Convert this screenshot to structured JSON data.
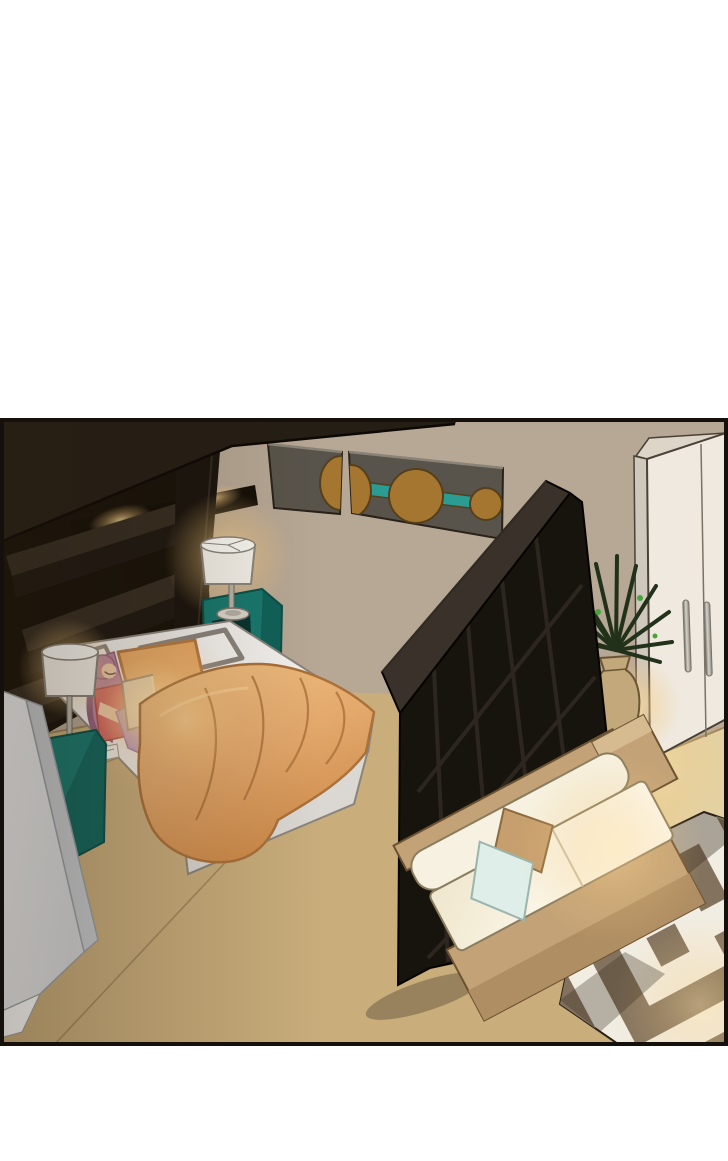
{
  "panel": {
    "x": 2,
    "y": 420,
    "width": 724,
    "height": 624
  },
  "scene": {
    "description": "Webtoon comic panel: isometric night bedroom. A pink-haired girl in a red tank top and purple pants sits on a white bed using a glowing laptop, an orange blanket draped off the bed. Dark headboard unit with lit niche, teal nightstands with white lamps, two abstract wall-art panels, a black grid room divider, a potted plant, a white wardrobe, a cream sofa with brown frame and two pillows, and a brown-white maze-pattern rug.",
    "objects": [
      "bed",
      "girl-with-laptop",
      "orange-blanket",
      "headboard-unit",
      "table-lamp-right",
      "table-lamp-left",
      "teal-nightstand-right",
      "teal-nightstand-left",
      "wall-art-panels",
      "room-divider-shelf",
      "potted-plant",
      "wardrobe",
      "sofa",
      "maze-rug",
      "white-partition"
    ]
  },
  "colors": {
    "pageBg": "#ffffff",
    "border": "#15100b",
    "wall": "#b7a795",
    "wallDark": "#5e4f3e",
    "floor": "#c9ad7b",
    "floorLight": "#e4d6ab",
    "floorLine": "#9a8158",
    "outline": "#2a2118",
    "canopy": "#251e15",
    "unitBody": "#171108",
    "shelf": "#352c21",
    "shelfDark": "#1e1811",
    "niche": "#140e07",
    "teal": "#17786e",
    "tealDark": "#0b4f49",
    "tealNotch": "#06332e",
    "lampShade": "#f3f0e8",
    "lampStem": "#b8b3a8",
    "bedWhite": "#f2f0ed",
    "bedSide": "#dbd7d2",
    "bedLine": "#8a847d",
    "pillowWhite": "#f6f4f0",
    "pillowOrange": "#eaa963",
    "blanketLine": "#aa713a",
    "hair": "#b77e9f",
    "hairDark": "#8f5a7c",
    "skin": "#f2cfb2",
    "topRed": "#d5605e",
    "pants": "#b593c8",
    "pantsDark": "#8e6aa6",
    "laptop": "#ded8cc",
    "partition": "#eef0f2",
    "partitionSide": "#c7cbcf",
    "partitionLine": "#9aa0a5",
    "dividerTop": "#3a322a",
    "dividerFace": "#17130d",
    "dividerLine": "#2f2922",
    "dividerHi": "#463d32",
    "artPanel": "#59544b",
    "artPanelHi": "#8a8478",
    "artOrange": "#a5762f",
    "artOrangeLine": "#553f1c",
    "artTeal": "#2b9c93",
    "wardrobeFront": "#efe9e0",
    "wardrobeSide": "#cfc8bd",
    "wardrobeTop": "#ddd5c8",
    "wardrobeLine": "#4a4236",
    "handleDark": "#77726a",
    "vase": "#c2a87b",
    "vaseLine": "#6b5535",
    "plant": "#22311a",
    "plantBright": "#49a33b",
    "sofaFrame": "#c3a277",
    "sofaFrameDark": "#b08e63",
    "sofaFrameTop": "#d6ba90",
    "sofaLine": "#6b5231",
    "cushion": "#f6f1e0",
    "cushionEdge": "#8a7d5f",
    "pillowTan": "#c79f6e",
    "pillowTanLine": "#8a6a40",
    "pillowBlue": "#dfeee8",
    "pillowBlueLine": "#9ab5ac",
    "rugWhite": "#f1ede2",
    "rugBrown": "#82725e"
  }
}
